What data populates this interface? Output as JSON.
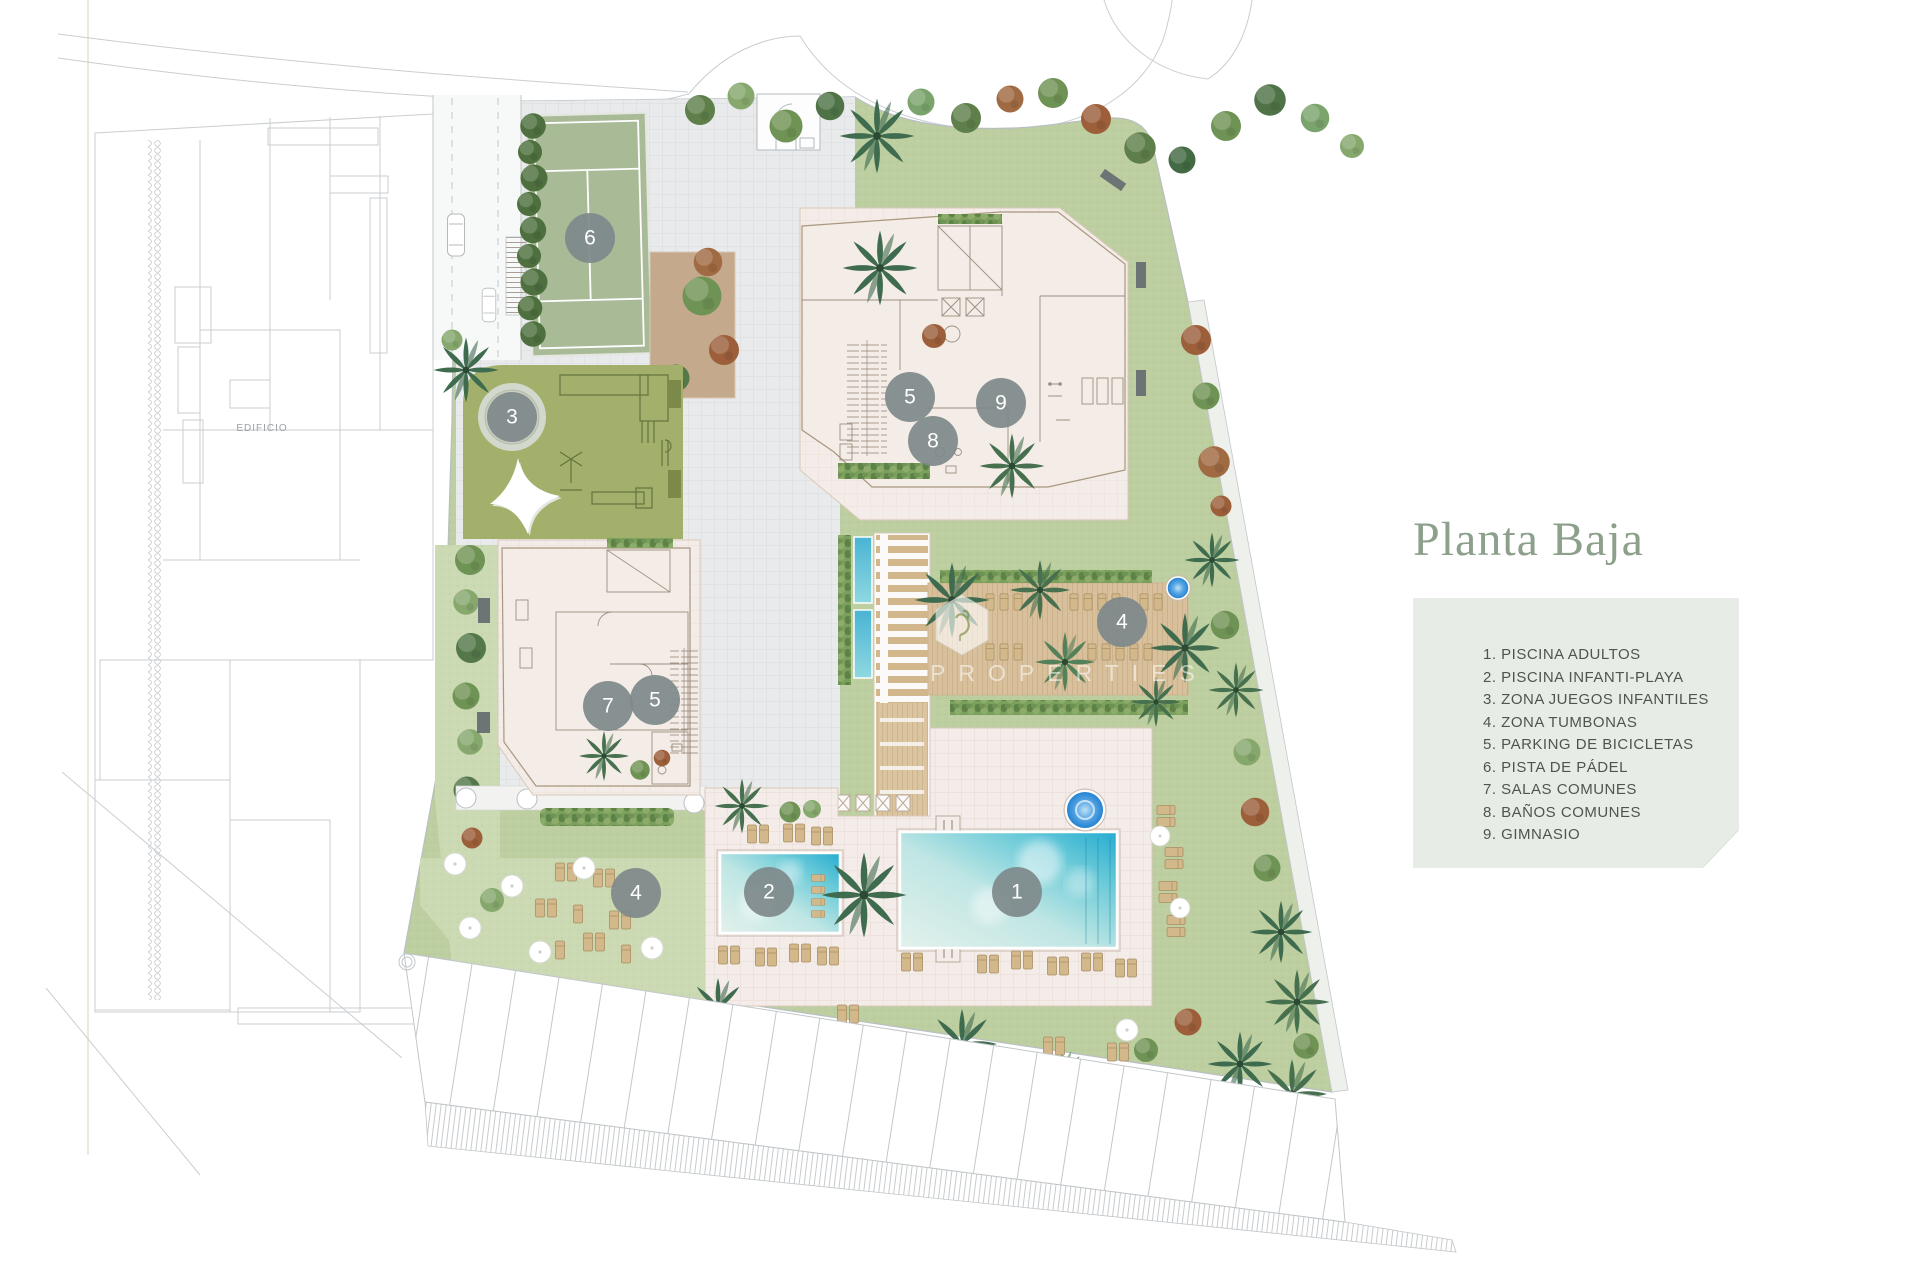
{
  "title": "Planta Baja",
  "legend": {
    "items": [
      "1. PISCINA ADULTOS",
      "2. PISCINA INFANTI-PLAYA",
      "3. ZONA JUEGOS INFANTILES",
      "4. ZONA TUMBONAS",
      "5. PARKING DE BICICLETAS",
      "6. PISTA DE PÁDEL",
      "7. SALAS COMUNES",
      "8. BAÑOS COMUNES",
      "9. GIMNASIO"
    ]
  },
  "plan": {
    "neighbor_building_label": "EDIFICIO",
    "watermark_text": "PROPERTIES",
    "markers": [
      {
        "area": "piscina-adultos",
        "label": "1"
      },
      {
        "area": "piscina-infantil-playa",
        "label": "2"
      },
      {
        "area": "zona-juegos-infantiles",
        "label": "3"
      },
      {
        "area": "zona-tumbonas-deck",
        "label": "4"
      },
      {
        "area": "zona-tumbonas-cesped",
        "label": "4"
      },
      {
        "area": "parking-bicicletas-norte",
        "label": "5"
      },
      {
        "area": "parking-bicicletas-sur",
        "label": "5"
      },
      {
        "area": "pista-de-padel",
        "label": "6"
      },
      {
        "area": "salas-comunes",
        "label": "7"
      },
      {
        "area": "banos-comunes",
        "label": "8"
      },
      {
        "area": "gimnasio",
        "label": "9"
      }
    ]
  },
  "colors": {
    "accent": "#8CA08C",
    "legend_bg": "#E8ECE6",
    "legend_text": "#4D564D",
    "lawn": "#BDCFA0",
    "lawn_light": "#CBDAB3",
    "court": "#A8BA96",
    "playground": "#A2B06B",
    "building": "#F4EDE7",
    "terrace": "#F3ECE8",
    "deck_wood": "#D8C09C",
    "water": "#2AACD2",
    "marker": "#7E898B"
  }
}
